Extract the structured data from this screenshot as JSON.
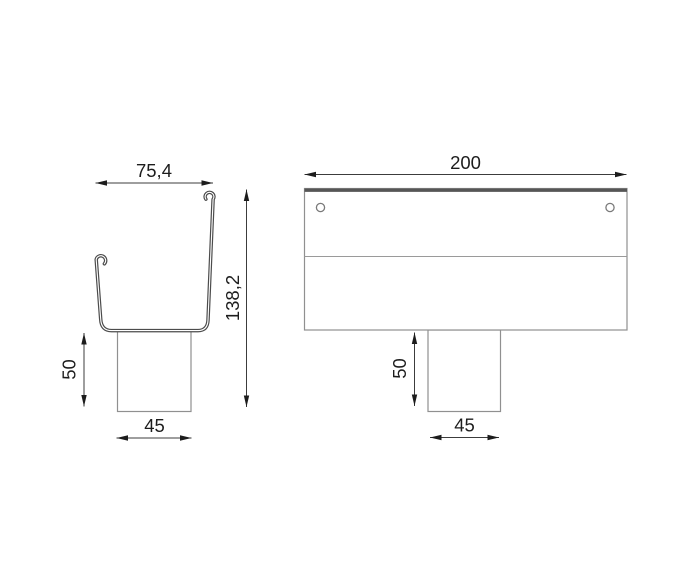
{
  "colors": {
    "background": "#ffffff",
    "part_outline": "#909090",
    "profile_stroke": "#4c4c4c",
    "top_edge": "#565656",
    "dimension_line": "#3c3c3c",
    "arrowhead": "#1c1c1c",
    "text": "#1d1d1d"
  },
  "side_view": {
    "dims": {
      "top_width": "75,4",
      "total_height": "138,2",
      "outlet_height": "50",
      "outlet_width": "45"
    }
  },
  "front_view": {
    "dims": {
      "width": "200",
      "outlet_height": "50",
      "outlet_width": "45"
    }
  }
}
